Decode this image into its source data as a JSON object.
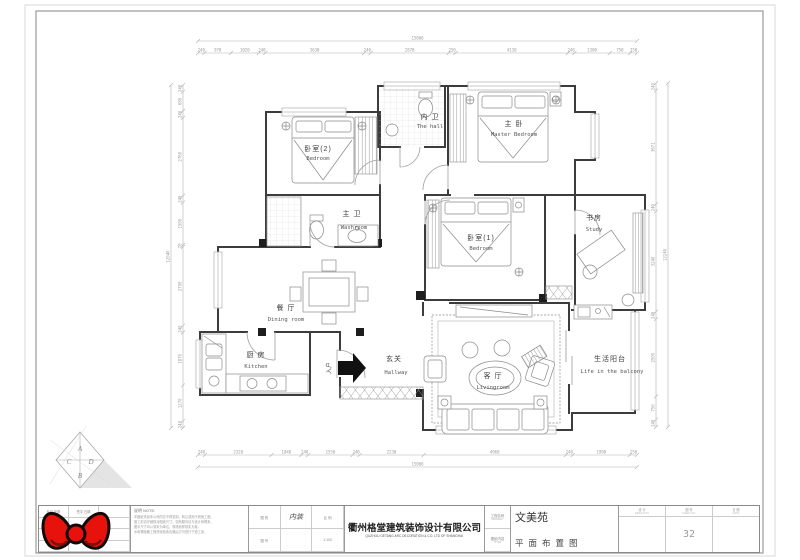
{
  "drawing": {
    "rooms": [
      {
        "zh": "卧室(2)",
        "en": "Bedroom"
      },
      {
        "zh": "内 卫",
        "en": "The hall"
      },
      {
        "zh": "主 卧",
        "en": "Master Bedroom"
      },
      {
        "zh": "主 卫",
        "en": "Washroom"
      },
      {
        "zh": "卧室(1)",
        "en": "Bedroom"
      },
      {
        "zh": "书房",
        "en": "Study"
      },
      {
        "zh": "餐 厅",
        "en": "Dining room"
      },
      {
        "zh": "厨 房",
        "en": "Kitchen"
      },
      {
        "zh": "玄关",
        "en": "Hallway"
      },
      {
        "zh": "客 厅",
        "en": "Livingroom"
      },
      {
        "zh": "生活阳台",
        "en": "Life in the balcony"
      }
    ],
    "entry_label": "入户",
    "dims": {
      "top": {
        "values": [
          "240",
          "970",
          "1020",
          "240",
          "3630",
          "240",
          "2870",
          "250",
          "4130",
          "240",
          "1300",
          "750",
          "250"
        ],
        "total": "15066"
      },
      "bottom": {
        "values": [
          "240",
          "2320",
          "1040",
          "240",
          "1550",
          "240",
          "2230",
          "4960",
          "240",
          "1990",
          "250"
        ],
        "total": "15066"
      },
      "left": {
        "values": [
          "240",
          "680",
          "240",
          "2760",
          "240",
          "1500",
          "70",
          "2790",
          "240",
          "1870",
          "1270",
          "240"
        ],
        "total": "12040"
      },
      "right": {
        "values": [
          "240",
          "3671",
          "240",
          "3240",
          "240",
          "2500",
          "750",
          "240"
        ],
        "total": "12240"
      }
    },
    "logo_letters": [
      "A",
      "D",
      "C",
      "B"
    ]
  },
  "title_block": {
    "revision_headers": [
      "标记 处数",
      "签字 日期",
      ""
    ],
    "notes": {
      "title": "说明 NOTE:",
      "lines": [
        "本图纸未经本公司同意不得复制、转让或用于其他工程。",
        "施工前请仔细核对图纸尺寸，如有疑问请与设计师联系。",
        "图中尺寸均以毫米为单位，现场放样核实为准。",
        "水电等隐蔽工程须经验收合格后方可进行下道工序。"
      ]
    },
    "info_cells": [
      [
        "图 别",
        "内装",
        "比 例"
      ],
      [
        "图 号",
        "",
        "1:100"
      ]
    ],
    "company": {
      "zh": "衢州格堂建筑装饰设计有限公司",
      "en": "QUZHOU GETANG ARC DECORATION & CO. LTD OF SHANGHAI"
    },
    "meta_labels": [
      {
        "zh": "工程名称",
        "en": "PROJECT"
      },
      {
        "zh": "图纸内容",
        "en": "TITLE"
      }
    ],
    "project": {
      "name": "文美苑",
      "drawing": "平面布置图"
    },
    "columns": [
      {
        "zh": "设 计",
        "en": "DESIGN BY"
      },
      {
        "zh": "图 号",
        "en": "SHEET NO."
      },
      {
        "zh": "日 期",
        "en": "DATE"
      }
    ],
    "page": "32"
  }
}
